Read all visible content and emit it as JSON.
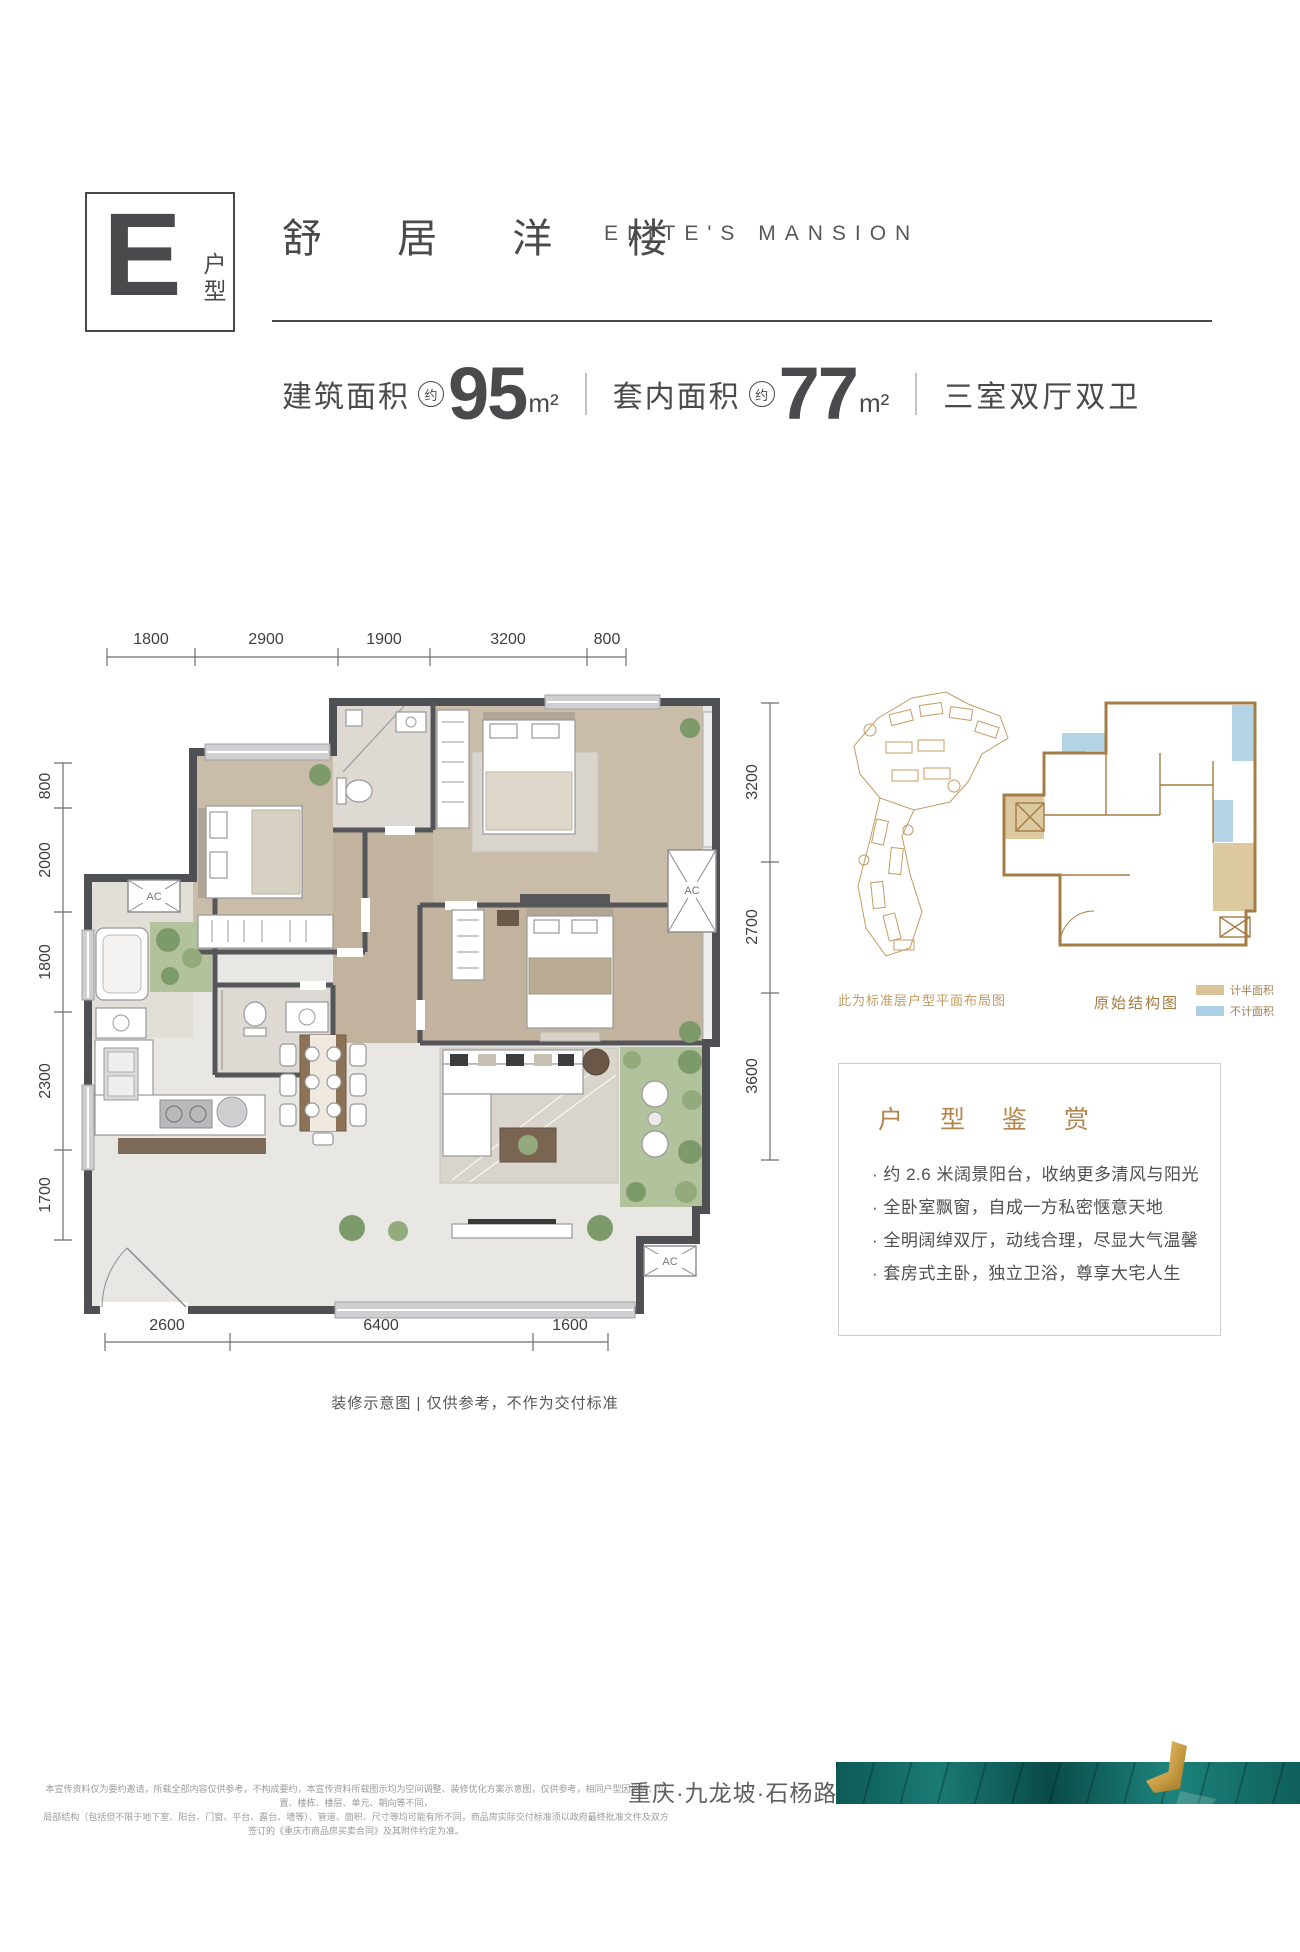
{
  "header": {
    "type_letter": "E",
    "type_label": "户型",
    "title_cn": "舒 居 洋 楼",
    "title_en": "ELITE'S MANSION",
    "stats": {
      "item1_label": "建筑面积",
      "item1_approx": "约",
      "item1_value": "95",
      "item1_unit": "m²",
      "divider1": "",
      "item2_label": "套内面积",
      "item2_approx": "约",
      "item2_value": "77",
      "item2_unit": "m²",
      "divider2": "",
      "item3": "三室双厅双卫"
    }
  },
  "floorplan": {
    "dims_top": [
      "1800",
      "2900",
      "1900",
      "3200",
      "800"
    ],
    "dims_left": [
      "800",
      "2000",
      "1800",
      "2300",
      "1700"
    ],
    "dims_right": [
      "3200",
      "2700",
      "3600"
    ],
    "dims_bottom": [
      "2600",
      "6400",
      "1600"
    ],
    "ac_label": "AC",
    "caption": "装修示意图 | 仅供参考，不作为交付标准"
  },
  "sidebar": {
    "siteplan_caption": "此为标准层户型平面布局图",
    "structure_caption": "原始结构图",
    "legend": [
      {
        "label": "计半面积",
        "color": "#d9c396"
      },
      {
        "label": "不计面积",
        "color": "#abd0e4"
      }
    ],
    "appreciation": {
      "title": "户 型 鉴 赏",
      "bullets": [
        "· 约 2.6 米阔景阳台，收纳更多清风与阳光",
        "· 全卧室飘窗，自成一方私密惬意天地",
        "· 全明阔绰双厅，动线合理，尽显大气温馨",
        "· 套房式主卧，独立卫浴，尊享大宅人生"
      ]
    }
  },
  "footer": {
    "disclaimer_line1": "本宣传资料仅为要约邀请，所载全部内容仅供参考，不构成要约，本宣传资料所载图示均为空间调整、装修优化方案示意图，仅供参考，相同户型因地势、位置、楼栋、楼层、单元、朝向等不同，",
    "disclaimer_line2": "局部结构（包括但不限于地下室、阳台、门窗、平台、露台、墙等）、管道、面积、尺寸等均可能有所不同，商品房实际交付标准须以政府最终批准文件及双方签订的《重庆市商品房买卖合同》及其附件约定为准。",
    "location": "重庆·九龙坡·石杨路",
    "banner_colors": {
      "teal_dark": "#0d5a56",
      "teal": "#1a7a74",
      "gold": "#c59a42"
    }
  }
}
